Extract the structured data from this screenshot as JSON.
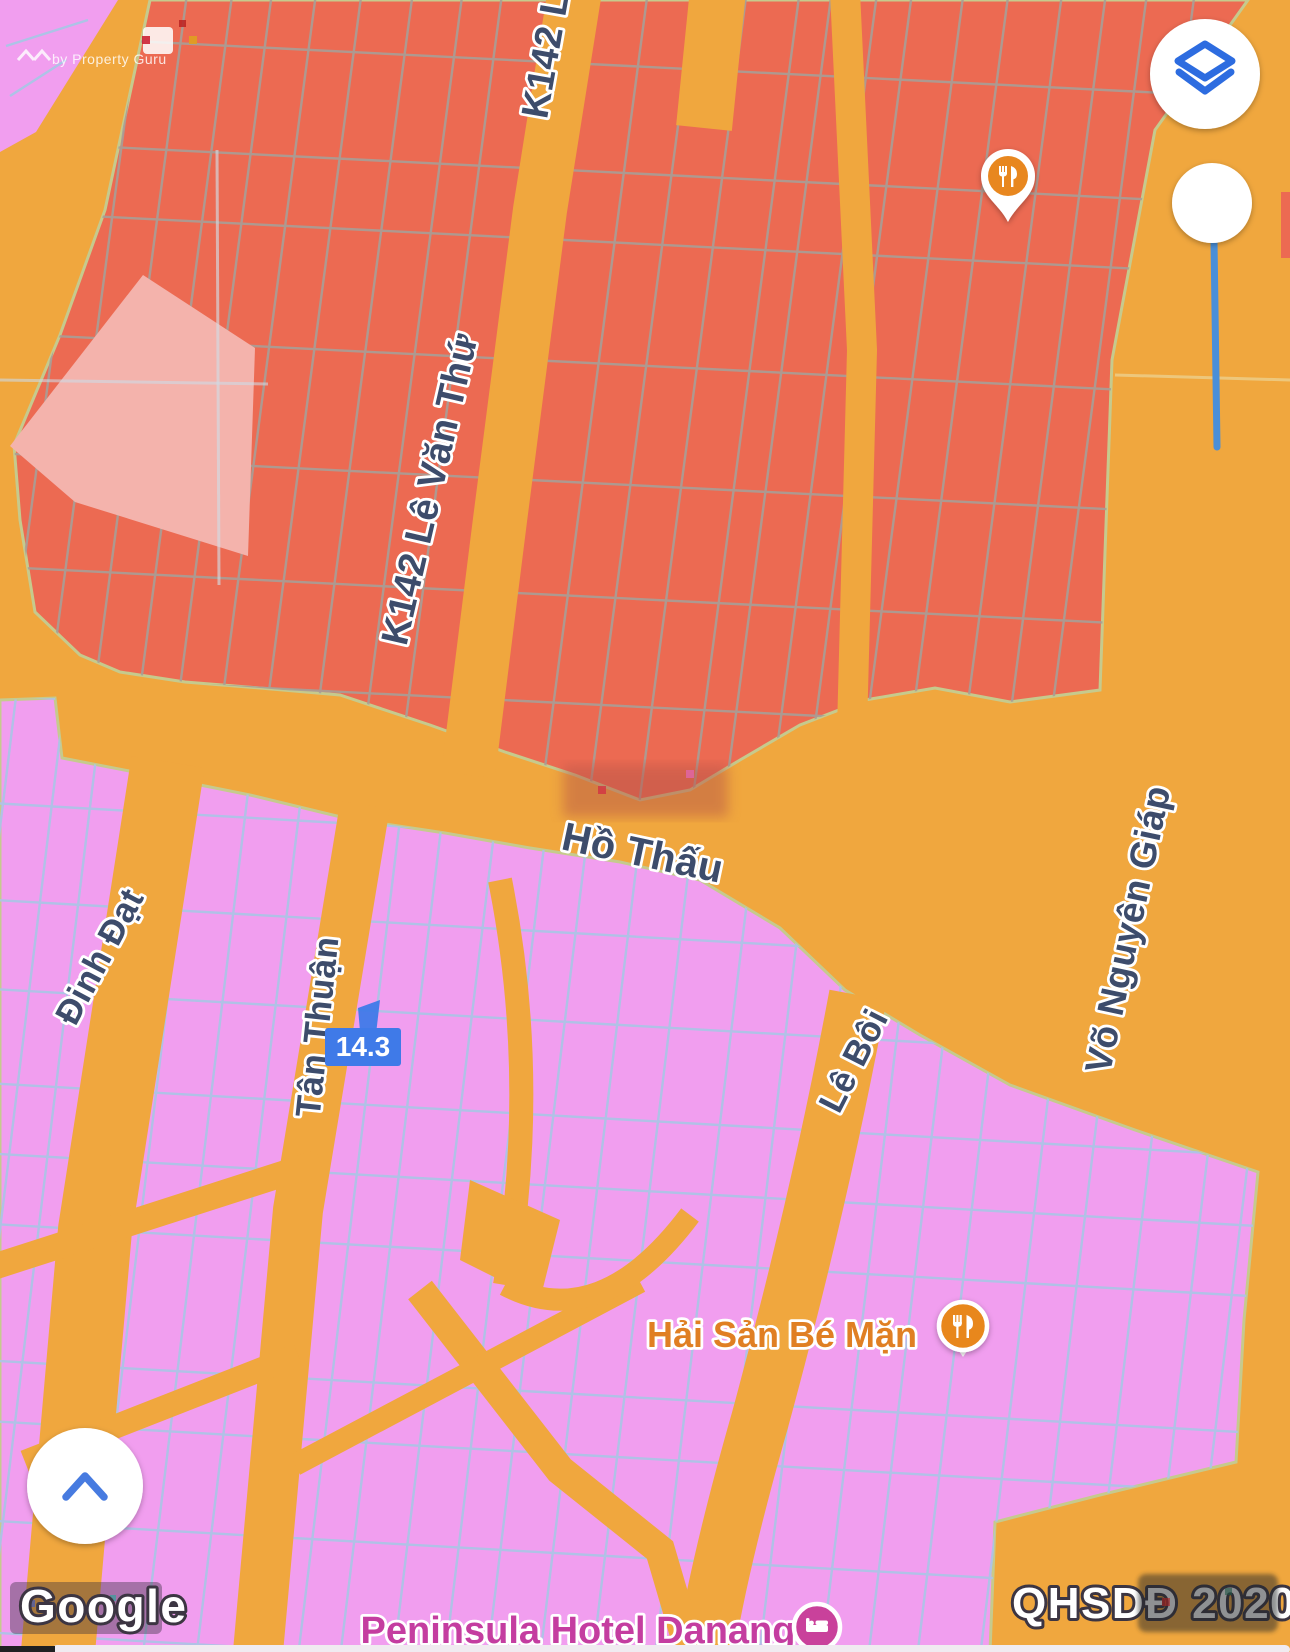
{
  "map": {
    "attribution": "Google",
    "overlay_tag": "QHSDĐ 2020",
    "watermark": "by Property Guru",
    "measurement": "14.3",
    "streets": {
      "k142": "K142 Lê Văn Thứ",
      "k142_partial": "K142 L",
      "ho_thau": "Hồ Thấu",
      "dinh_dat": "Đinh Đạt",
      "tan_thuan": "Tân Thuận",
      "le_boi": "Lê Bôi",
      "vo_nguyen_giap": "Võ Nguyên Giáp"
    },
    "pois": {
      "restaurant_north": {
        "label": "",
        "type": "restaurant"
      },
      "hai_san": {
        "label": "Hải Sản Bé Mặn",
        "type": "restaurant"
      },
      "peninsula": {
        "label": "Peninsula Hotel Danang",
        "type": "hotel"
      }
    },
    "icons": {
      "layers": "layers-icon",
      "slider": "overlay-opacity-slider",
      "expand": "chevron-up-icon",
      "restaurant": "fork-knife-icon",
      "hotel": "bed-icon"
    },
    "colors": {
      "road_orange": "#f0a73e",
      "parcel_red": "#ec6a52",
      "parcel_light_pink": "#f4b3ac",
      "parcel_pink": "#f19eef",
      "red_parcel_border": "#a89f97",
      "pink_parcel_border": "#adc3e6",
      "road_edge": "#c6ca8d",
      "label_text": "#3d4c6b",
      "poi_orange": "#e8871f",
      "poi_magenta": "#c9419b",
      "accent_blue": "#3f7ae8"
    }
  }
}
